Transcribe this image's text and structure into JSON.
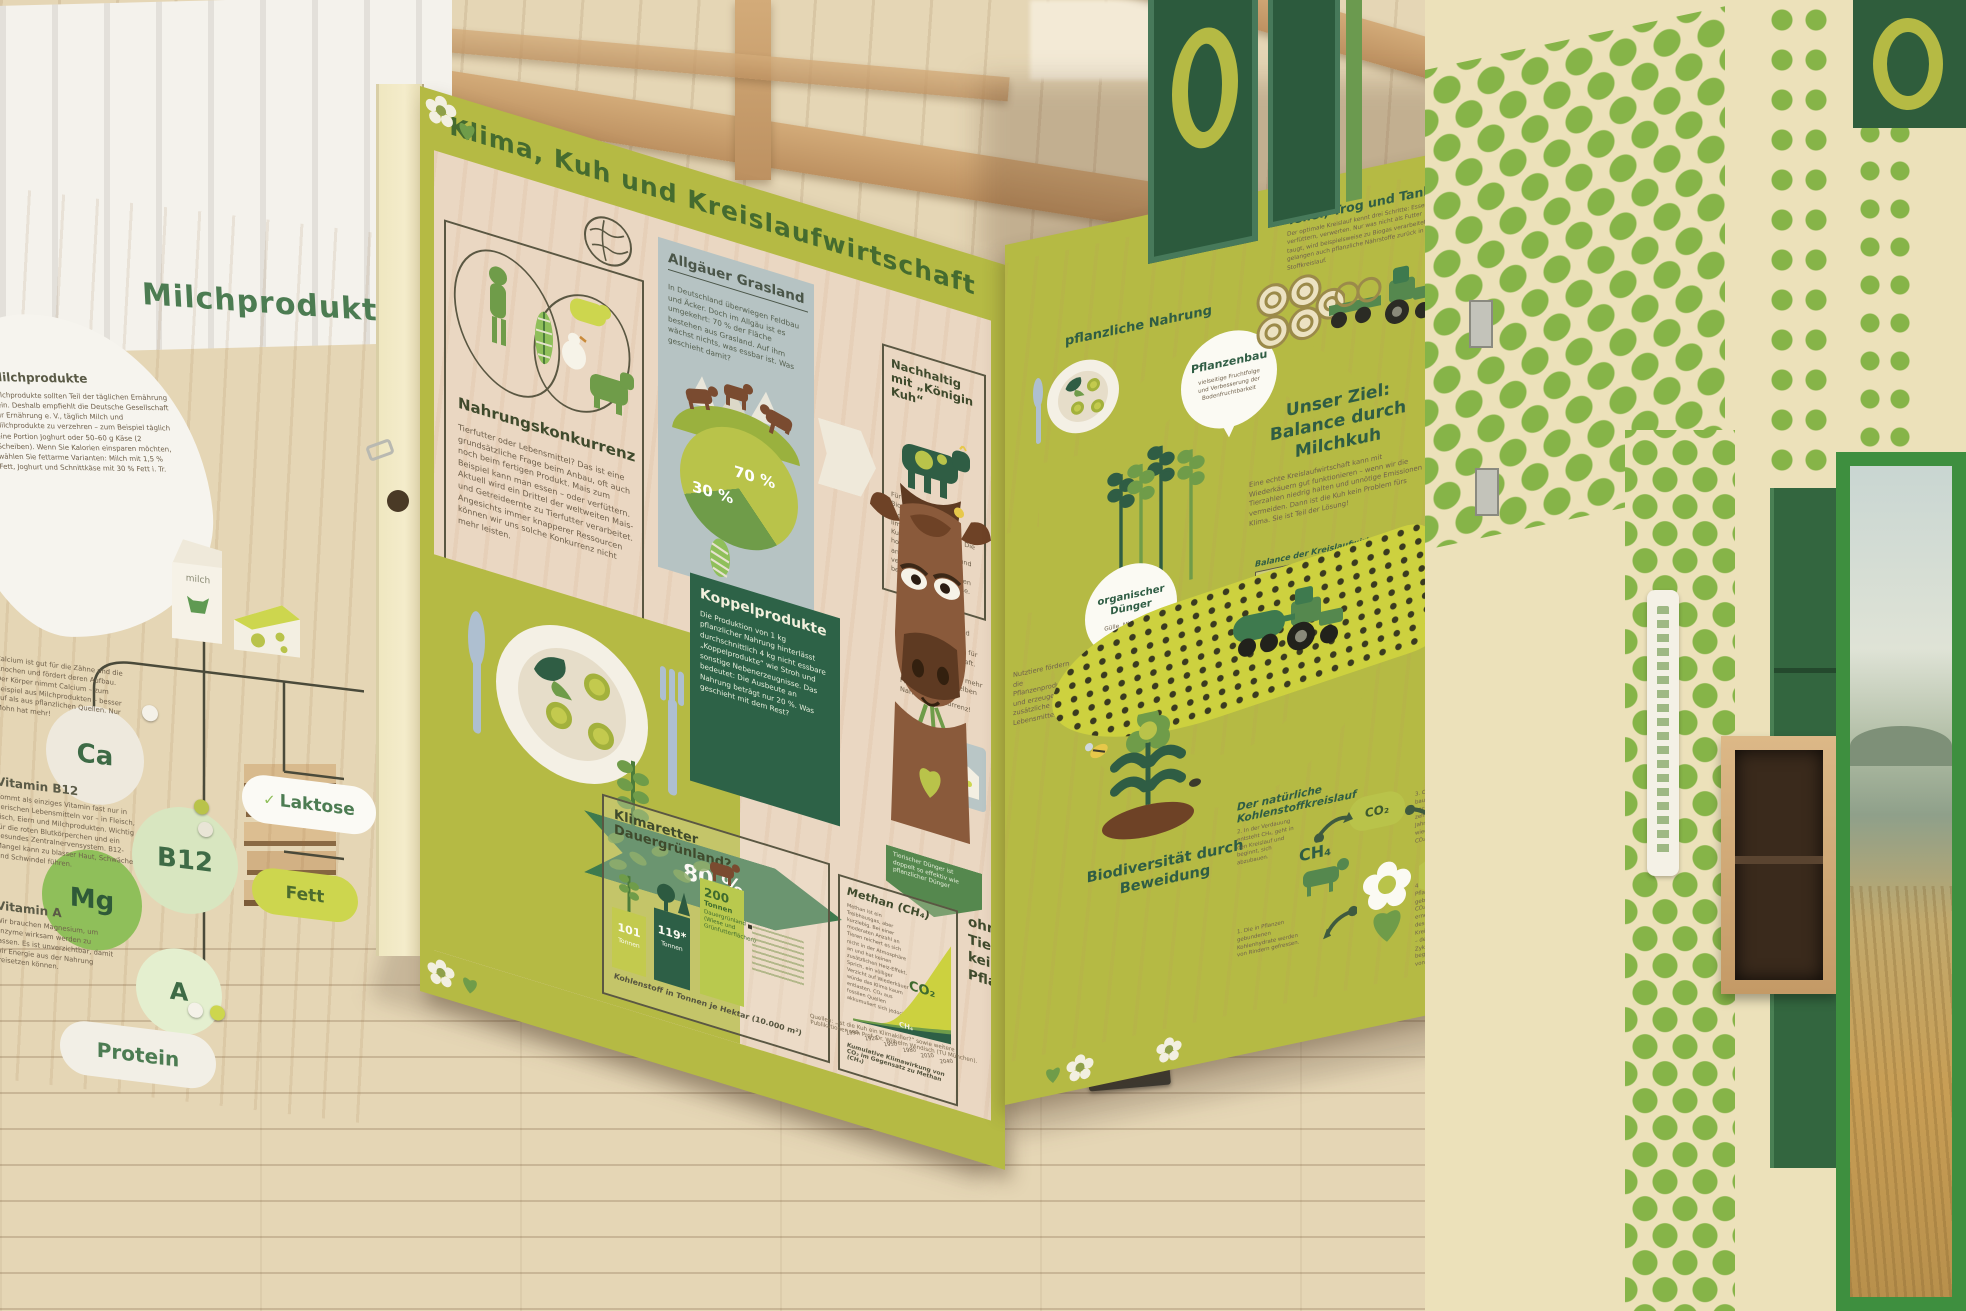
{
  "colors": {
    "lime": "#b5ba44",
    "dark_green": "#2d6247",
    "mid_green": "#6f9c49",
    "pie_light": "#b9c34a",
    "blue_grey_box": "#b6c3c3",
    "cow_brown": "#8a5a3b",
    "wall_green": "#86b448",
    "door_green": "#3e8f3f",
    "wood_pink": "#ead7c2"
  },
  "main_panel": {
    "title": "Klima, Kuh und Kreislaufwirtschaft",
    "nahrungskonkurrenz": {
      "heading": "Nahrungskonkurrenz",
      "body": "Tierfutter oder Lebensmittel? Das ist eine grundsätzliche Frage beim Anbau, oft auch noch beim fertigen Produkt. Mais zum Beispiel kann man essen – oder verfüttern. Aktuell wird ein Drittel der weltweiten Mais- und Getreideernte zu Tierfutter verarbeitet. Angesichts immer knapperer Ressourcen können wir uns solche Konkurrenz nicht mehr leisten."
    },
    "allgaeu": {
      "heading": "Allgäuer Grasland",
      "body": "In Deutschland überwiegen Feldbau und Äcker. Doch im Allgäu ist es umgekehrt: 70 % der Fläche bestehen aus Grasland. Auf ihm wächst nichts, was essbar ist. Was geschieht damit?",
      "pie": {
        "type": "pie",
        "labels": [
          "70 %",
          "30 %"
        ],
        "values": [
          70,
          30
        ]
      }
    },
    "nachhaltig": {
      "heading": "Nachhaltig mit „Königin Kuh“",
      "body": "Für uns nicht essbare Biomasse ist eine regenerierbare, aber limitierte Futterquelle. Die Kuh verwertet sie hocheffizient: Rinder und andere Wiederkäuer verdauen in ihren Mägen beispielsweise Zellulose."
    },
    "treibstoff": "Daher sind Milch und Milchprodukte der perfekte „Treibstoff“ für die Kreislaufwirtschaft. Durch Nutztiere gewinnen wir 50 % mehr Nahrung aus derselben Fläche – ohne Nahrungskonkurrenz!",
    "koppelprodukte": {
      "heading": "Koppelprodukte",
      "body": "Die Produktion von 1 kg pflanzlicher Nahrung hinterlässt durchschnittlich 4 kg nicht essbare „Koppelprodukte“ wie Stroh und sonstige Nebenerzeugnisse. Das bedeutet: Die Ausbeute an Nahrung beträgt nur 20 %. Was geschieht mit dem Rest?"
    },
    "flow": {
      "eaten": "20 %",
      "rest": "80 %"
    },
    "duenger_note": "Tierischer Dünger ist doppelt so effektiv wie pflanzlicher Dünger",
    "klimaretter": {
      "heading": "Klimaretter Dauergrünland?",
      "caption": "Kohlenstoff in Tonnen je Hektar (10.000 m²)",
      "chart": {
        "type": "bar",
        "bars": [
          {
            "value": "101",
            "unit": "Tonnen",
            "icon": "wheat-icon",
            "tonnes": 101
          },
          {
            "value": "119*",
            "unit": "Tonnen",
            "icon": "forest-icon",
            "tonnes": 119
          },
          {
            "value": "200",
            "unit": "Tonnen",
            "extra": "Dauergrünland (Wiese und Grünfutterflächen)",
            "icon": "cow-icon",
            "tonnes": 200
          }
        ]
      }
    },
    "methan": {
      "heading": "Methan (CH₄)",
      "body": "Methan ist ein Treibhausgas, aber kurzlebig. Bei einer moderaten Anzahl an Tieren reichert es sich nicht in der Atmosphäre an und hat keinen zusätzlichen Heiz-Effekt. Sprich, ein völliger Verzicht auf Wiederkäuer würde das Klima kaum entlasten. CO₂ aus fossilen Quellen akkumuliert sich jedoch.",
      "co2_label": "CO₂",
      "ch4_label": "CH₄",
      "caption": "Kumulative Klimawirkung von CO₂ im Gegensatz zu Methan (CH₄)",
      "chart": {
        "type": "area",
        "years": [
          "1890",
          "1920",
          "1950",
          "1980",
          "2010",
          "2040"
        ],
        "series": [
          {
            "name": "CO₂",
            "values": [
              2,
              8,
              20,
              45,
              75,
              100
            ]
          },
          {
            "name": "CH₄",
            "values": [
              2,
              4,
              6,
              8,
              9,
              10
            ]
          }
        ]
      }
    },
    "ohne_tiere": "ohne Tiere keine Pflanzen",
    "stickstoff": {
      "title": "Stickstoff-Effizienz in Pflanzenbau-Systemen",
      "chart": {
        "type": "bar",
        "categories": [
          "Rotte",
          "Biogas",
          "Milch"
        ],
        "values": [
          35,
          80,
          95
        ]
      }
    },
    "sources": "Quellen: „Ist die Kuh ein Klimakiller?“ sowie weitere Publikationen von Prof. Dr. Wilhelm Windisch (TU München)."
  },
  "right_panel": {
    "pflanzliche_nahrung": "pflanzliche Nahrung",
    "pflanzenbau": {
      "label": "Pflanzenbau",
      "note": "vielseitige Fruchtfolge und Verbesserung der Bodenfruchtbarkeit"
    },
    "ttt": {
      "heading": "Teller, Trog und Tank",
      "body": "Der optimale Kreislauf kennt drei Schritte: Essen, verfüttern, verwerten. Nur was nicht als Futter taugt, wird beispielsweise zu Biogas verarbeitet. So gelangen auch pflanzliche Nährstoffe zurück in den Stoffkreislauf."
    },
    "cow_note": "Nutztiere fördern die Pflanzenproduktion und erzeugen zusätzliche Lebensmittel",
    "unser_ziel": {
      "heading": "Unser Ziel: Balance durch Milchkuh",
      "body": "Eine echte Kreislaufwirtschaft kann mit Wiederkäuern gut funktionieren – wenn wir die Tierzahlen niedrig halten und unnötige Emissionen vermeiden. Dann ist die Kuh kein Problem fürs Klima. Sie ist Teil der Lösung!"
    },
    "balance": {
      "title": "Balance der Kreislaufwirtschaft",
      "band": "Ohne Nutztiere",
      "ann_high": "Hoch-intensive Tierproduktion, Nahrungskonkurrenz, Landnutzungsänderung",
      "ann_low": "Low-input-Tierproduktion auf unvermeidbar anfallender, nicht essbarer Biomasse"
    },
    "org_duenger": {
      "label": "organischer Dünger",
      "note": "Gülle, Mist, Jauche"
    },
    "biodiversitaet": "Biodiversität durch Beweidung",
    "carbon": {
      "heading": "Der natürliche Kohlenstoffkreislauf",
      "ch4": "CH₄",
      "co2": "CO₂",
      "steps": [
        "1. Die in Pflanzen gebundenen Kohlenhydrate werden von Rindern gefressen.",
        "2. In der Verdauung entsteht CH₄, geht in den Kreislauf und beginnt, sich abzubauen.",
        "3. CH₄ baut sich nach rund zehn Jahren wieder zu CO₂ ab.",
        "4. Das in Pflanzen gebundene CO₂ wird erneut Teil des Kreislaufs – der Zyklus beginnt von vorn."
      ]
    }
  },
  "milk_wall": {
    "title": "Milchprodukte",
    "blob": {
      "heading": "Milchprodukte",
      "body": "Milchprodukte sollten Teil der täglichen Ernährung sein. Deshalb empfiehlt die Deutsche Gesellschaft für Ernährung e. V., täglich Milch und Milchprodukte zu verzehren – zum Beispiel täglich eine Portion Joghurt oder 50–60 g Käse (2 Scheiben). Wenn Sie Kalorien einsparen möchten, wählen Sie fettarme Varianten: Milch mit 1,5 % Fett, Joghurt und Schnittkäse mit 30 % Fett i. Tr."
    },
    "ca_text": "Calcium ist gut für die Zähne und die Knochen und fördert deren Aufbau. Der Körper nimmt Calcium – zum Beispiel aus Milchprodukten – besser auf als aus pflanzlichen Quellen. Nur Mohn hat mehr!",
    "h_b12": "Vitamin B12",
    "b12_text": "Kommt als einziges Vitamin fast nur in tierischen Lebensmitteln vor – in Fleisch, Fisch, Eiern und Milchprodukten. Wichtig für die roten Blutkörperchen und ein gesundes Zentralnervensystem. B12-Mangel kann zu blasser Haut, Schwäche und Schwindel führen.",
    "h_a": "Vitamin A",
    "mg_text": "Wir brauchen Magnesium, um Enzyme wirksam werden zu lassen. Es ist unverzichtbar, damit wir Energie aus der Nahrung freisetzen können.",
    "nutrients": {
      "ca": "Ca",
      "b12": "B12",
      "mg": "Mg",
      "a": "A",
      "protein": "Protein",
      "laktose": "Laktose",
      "fett": "Fett"
    },
    "check": "✓",
    "milk_label": "milch"
  }
}
